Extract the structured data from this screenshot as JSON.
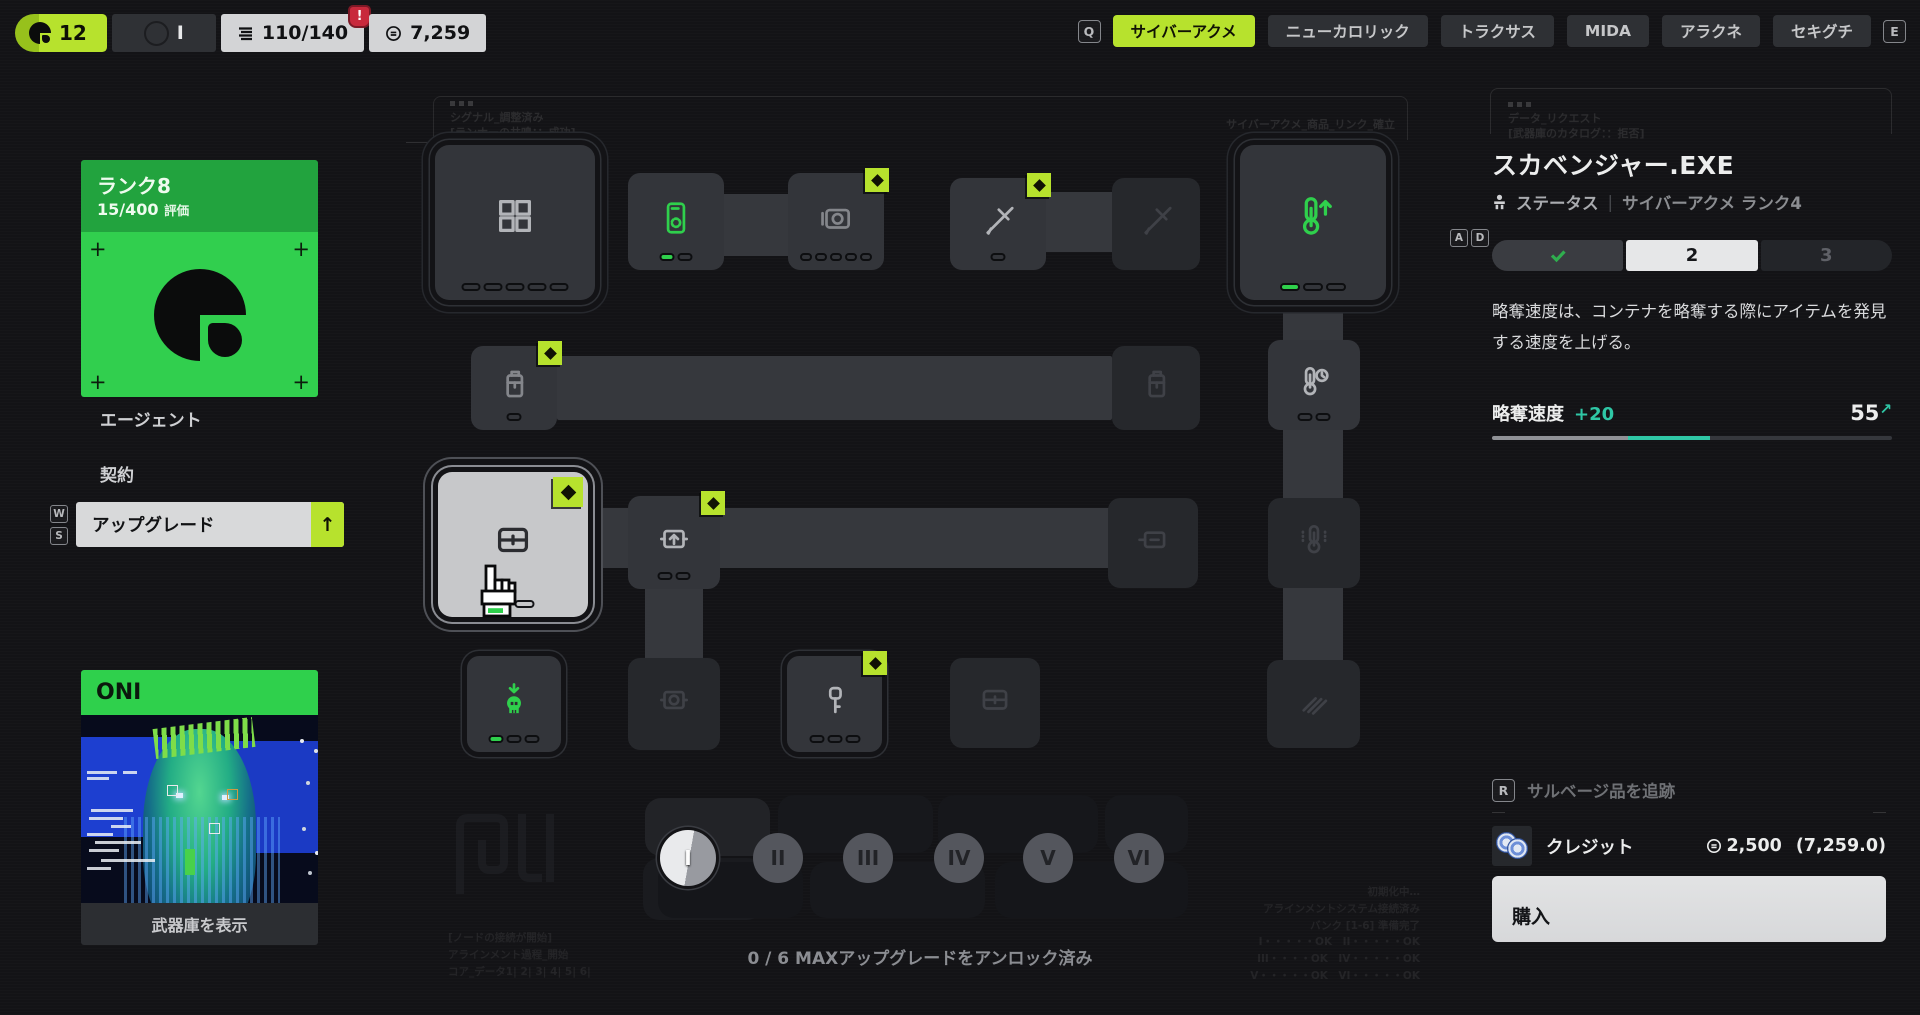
{
  "colors": {
    "accent": "#b7e22d",
    "green": "#2fd04c",
    "teal": "#2fc7a6",
    "alert_red": "#c8293c"
  },
  "top_bar": {
    "level": "12",
    "slot_label": "I",
    "capacity": "110/140",
    "alert": "!",
    "wallet": "7,259",
    "key_prev": "Q",
    "key_next": "E",
    "tabs": [
      {
        "label": "サイバーアクメ",
        "active": true
      },
      {
        "label": "ニューカロリック",
        "active": false
      },
      {
        "label": "トラクサス",
        "active": false
      },
      {
        "label": "MIDA",
        "active": false
      },
      {
        "label": "アラクネ",
        "active": false
      },
      {
        "label": "セキグチ",
        "active": false
      }
    ]
  },
  "sidebar": {
    "rank_title": "ランク8",
    "rank_progress": "15/400",
    "rank_suffix": "評価",
    "corner_mark": "+",
    "agent_label": "エージェント",
    "contract_label": "契約",
    "upgrade_label": "アップグレード",
    "upgrade_arrow": "↑",
    "key_up": "W",
    "key_down": "S",
    "oni_title": "ONI",
    "armory_label": "武器庫を表示"
  },
  "tree": {
    "frame_note": {
      "line1": "シグナル_調整済み",
      "line2": "[ランナーの共鳴：：成功]"
    },
    "link_note": "サイバーアクメ_商品_リンク_確立",
    "corner_notes_left": [
      "[ノードの接続が開始]",
      "アラインメント過程_開始",
      "コア_データ1| 2| 3| 4| 5| 6|"
    ],
    "corner_notes_right": [
      "初期化中…",
      "アラインメントシステム接続済み",
      "バンク [1-6] 準備完了",
      "I・・・・・OK　II・・・・・OK",
      "III・・・・OK　IV・・・・・OK",
      "V・・・・・OK　VI・・・・・OK"
    ],
    "tiers": [
      "I",
      "II",
      "III",
      "IV",
      "V",
      "VI"
    ],
    "active_tier": "I",
    "unlock_status": "0 / 6 MAXアップグレードをアンロック済み",
    "nodes": [
      {
        "name": "storage-grid",
        "icon": "grid",
        "x": 435,
        "y": 145,
        "w": 160,
        "h": 155,
        "state": "active",
        "rings": 2,
        "badge": false,
        "pips": [
          5,
          0
        ],
        "tone": "light"
      },
      {
        "name": "scanner-phone",
        "icon": "phone",
        "x": 628,
        "y": 173,
        "w": 96,
        "h": 97,
        "state": "active",
        "rings": 0,
        "badge": false,
        "pips": [
          2,
          1
        ],
        "tone": "green"
      },
      {
        "name": "camera",
        "icon": "camera",
        "x": 788,
        "y": 173,
        "w": 96,
        "h": 97,
        "state": "active",
        "rings": 0,
        "badge": true,
        "pips": [
          5,
          0
        ],
        "tone": "mid"
      },
      {
        "name": "melee",
        "icon": "sword",
        "x": 950,
        "y": 178,
        "w": 96,
        "h": 92,
        "state": "active",
        "rings": 0,
        "badge": true,
        "pips": [
          1,
          0
        ],
        "tone": "light"
      },
      {
        "name": "melee-2",
        "icon": "sword",
        "x": 1112,
        "y": 178,
        "w": 88,
        "h": 92,
        "state": "dim",
        "rings": 0,
        "badge": false,
        "pips": null,
        "tone": "dim"
      },
      {
        "name": "loot-speed",
        "icon": "thermo-up",
        "x": 1240,
        "y": 145,
        "w": 146,
        "h": 155,
        "state": "active",
        "rings": 2,
        "badge": false,
        "pips": [
          3,
          1
        ],
        "tone": "green"
      },
      {
        "name": "canister",
        "icon": "canister",
        "x": 471,
        "y": 346,
        "w": 86,
        "h": 84,
        "state": "active",
        "rings": 0,
        "badge": true,
        "pips": [
          1,
          0
        ],
        "tone": "mid"
      },
      {
        "name": "canister-2",
        "icon": "canister",
        "x": 1112,
        "y": 346,
        "w": 88,
        "h": 84,
        "state": "dim",
        "rings": 0,
        "badge": false,
        "pips": null,
        "tone": "dim"
      },
      {
        "name": "thermo-clock",
        "icon": "thermo-clock",
        "x": 1268,
        "y": 340,
        "w": 92,
        "h": 90,
        "state": "active",
        "rings": 0,
        "badge": false,
        "pips": [
          2,
          0
        ],
        "tone": "light"
      },
      {
        "name": "loot-container",
        "icon": "container",
        "x": 438,
        "y": 472,
        "w": 150,
        "h": 145,
        "state": "selected",
        "rings": 2,
        "badge": true,
        "pips": [
          2,
          1
        ],
        "tone": "dark",
        "cursor": true
      },
      {
        "name": "stash-up",
        "icon": "box-up",
        "x": 628,
        "y": 496,
        "w": 92,
        "h": 93,
        "state": "active",
        "rings": 0,
        "badge": true,
        "pips": [
          2,
          0
        ],
        "tone": "light"
      },
      {
        "name": "container-link",
        "icon": "container-left",
        "x": 1108,
        "y": 498,
        "w": 90,
        "h": 90,
        "state": "dim",
        "rings": 0,
        "badge": false,
        "pips": null,
        "tone": "dim"
      },
      {
        "name": "thermo-dots",
        "icon": "thermo-dots",
        "x": 1268,
        "y": 498,
        "w": 92,
        "h": 90,
        "state": "dim",
        "rings": 0,
        "badge": false,
        "pips": null,
        "tone": "dim"
      },
      {
        "name": "drop-skull",
        "icon": "skull-down",
        "x": 467,
        "y": 656,
        "w": 94,
        "h": 96,
        "state": "active",
        "rings": 1,
        "badge": false,
        "pips": [
          3,
          1
        ],
        "tone": "green"
      },
      {
        "name": "coin-box",
        "icon": "coin-box",
        "x": 628,
        "y": 658,
        "w": 92,
        "h": 92,
        "state": "dim",
        "rings": 0,
        "badge": false,
        "pips": null,
        "tone": "dim"
      },
      {
        "name": "key-unlock",
        "icon": "key",
        "x": 787,
        "y": 656,
        "w": 95,
        "h": 96,
        "state": "active",
        "rings": 1,
        "badge": true,
        "pips": [
          3,
          0
        ],
        "tone": "light"
      },
      {
        "name": "container-2",
        "icon": "container",
        "x": 950,
        "y": 658,
        "w": 90,
        "h": 90,
        "state": "dim",
        "rings": 0,
        "badge": false,
        "pips": null,
        "tone": "dim"
      },
      {
        "name": "glide",
        "icon": "diagonal",
        "x": 1267,
        "y": 660,
        "w": 93,
        "h": 88,
        "state": "dim",
        "rings": 0,
        "badge": false,
        "pips": null,
        "tone": "dim"
      }
    ]
  },
  "detail": {
    "frame_note": {
      "line1": "データ_リクエスト",
      "line2": "[武器庫のカタログ：：拒否]"
    },
    "title": "スカベンジャー.EXE",
    "status_label": "ステータス",
    "subtitle_divider": "|",
    "vendor_rank": "サイバーアクメ ランク4",
    "key_left": "A",
    "key_right": "D",
    "level_current": "2",
    "level_next": "3",
    "description": "略奪速度は、コンテナを略奪する際にアイテムを発見する速度を上げる。",
    "stat_name": "略奪速度",
    "stat_delta": "+20",
    "stat_value": "55",
    "stat_trend": "↗",
    "track_key": "R",
    "track_label": "サルベージ品を追跡",
    "cost_label": "クレジット",
    "cost_price": "2,500",
    "cost_balance": "(7,259.0)",
    "buy_label": "購入"
  }
}
